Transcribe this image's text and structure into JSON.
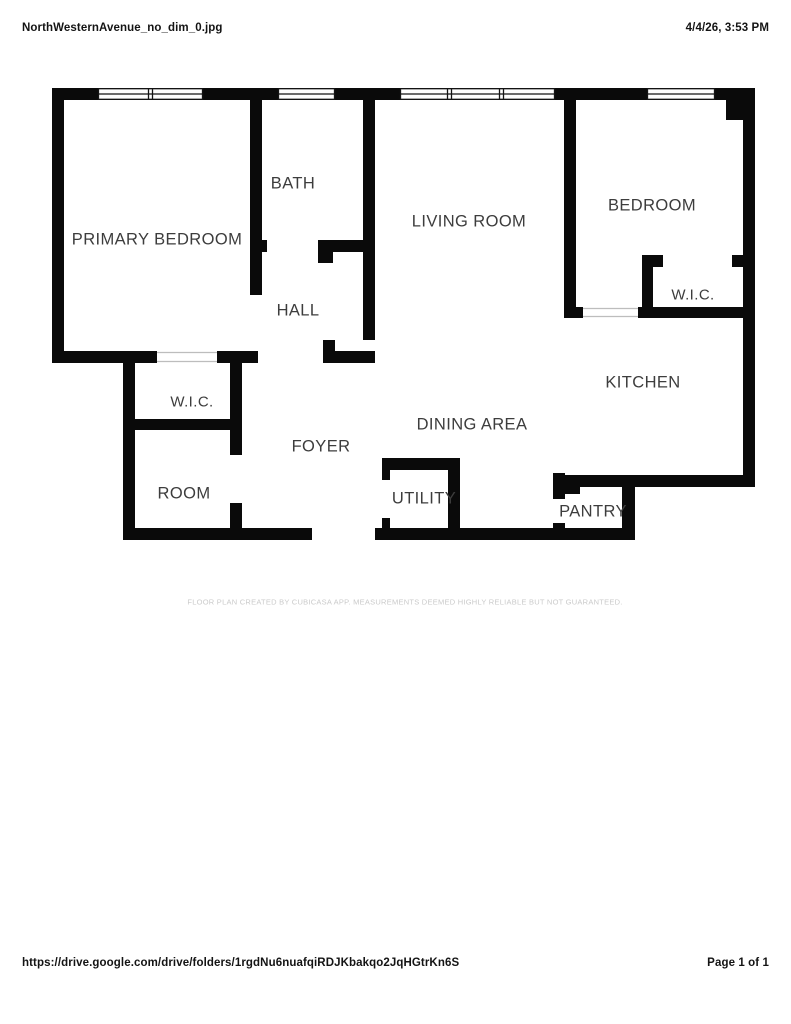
{
  "header": {
    "filename": "NorthWesternAvenue_no_dim_0.jpg",
    "timestamp": "4/4/26, 3:53 PM"
  },
  "footer": {
    "url": "https://drive.google.com/drive/folders/1rgdNu6nuafqiRDJKbakqo2JqHGtrKn6S",
    "page_indicator": "Page 1 of 1"
  },
  "floorplan": {
    "disclaimer": "FLOOR PLAN CREATED BY CUBICASA APP. MEASUREMENTS DEEMED HIGHLY RELIABLE BUT NOT GUARANTEED.",
    "colors": {
      "walls": "#0a0a0a",
      "labels": "#3d3d3d",
      "disclaimer": "#cacaca"
    },
    "rooms": [
      {
        "id": "primary-bedroom",
        "label": "PRIMARY BEDROOM",
        "x": 157,
        "y": 240
      },
      {
        "id": "bath",
        "label": "BATH",
        "x": 293,
        "y": 184
      },
      {
        "id": "hall",
        "label": "HALL",
        "x": 298,
        "y": 311
      },
      {
        "id": "living-room",
        "label": "LIVING ROOM",
        "x": 469,
        "y": 222
      },
      {
        "id": "bedroom",
        "label": "BEDROOM",
        "x": 652,
        "y": 206
      },
      {
        "id": "wic-bedroom",
        "label": "W.I.C.",
        "x": 693,
        "y": 295
      },
      {
        "id": "kitchen",
        "label": "KITCHEN",
        "x": 643,
        "y": 383
      },
      {
        "id": "dining-area",
        "label": "DINING AREA",
        "x": 472,
        "y": 425
      },
      {
        "id": "foyer",
        "label": "FOYER",
        "x": 321,
        "y": 447
      },
      {
        "id": "wic-left",
        "label": "W.I.C.",
        "x": 192,
        "y": 402
      },
      {
        "id": "room",
        "label": "ROOM",
        "x": 184,
        "y": 494
      },
      {
        "id": "utility",
        "label": "UTILITY",
        "x": 424,
        "y": 499
      },
      {
        "id": "pantry",
        "label": "PANTRY",
        "x": 593,
        "y": 512
      }
    ]
  }
}
